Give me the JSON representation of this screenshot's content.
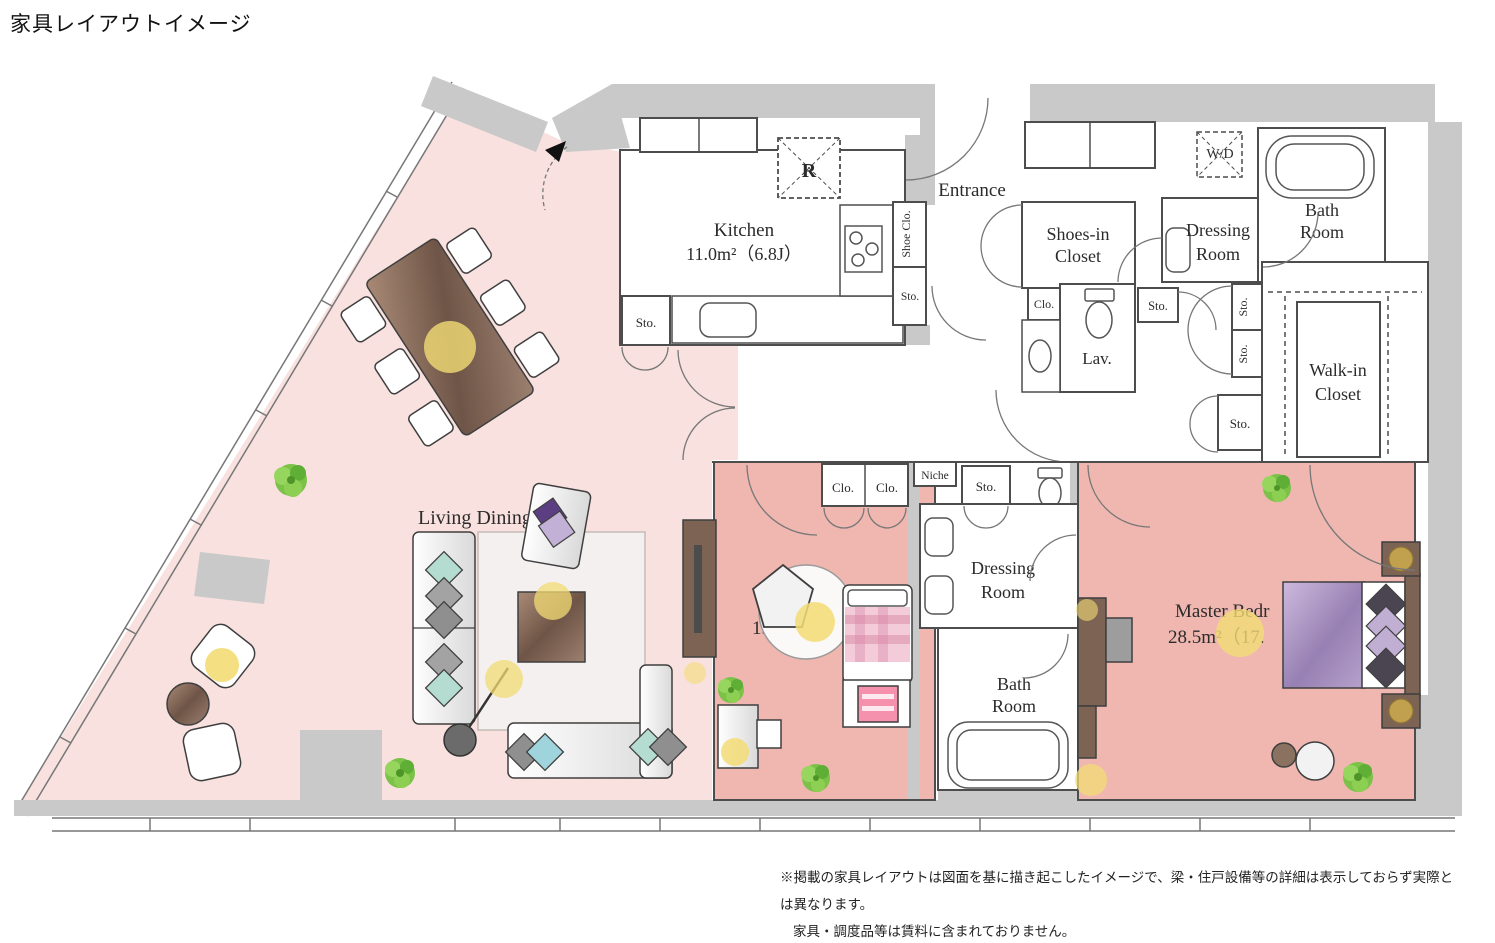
{
  "title": "家具レイアウトイメージ",
  "rooms": {
    "kitchen": {
      "name": "Kitchen",
      "area": "11.0m²（6.8J）"
    },
    "living_dining": {
      "name": "Living Dining Room"
    },
    "entrance": {
      "name": "Entrance"
    },
    "shoes_in_closet": {
      "line1": "Shoes-in",
      "line2": "Closet"
    },
    "dressing_room_top": {
      "line1": "Dressing",
      "line2": "Room"
    },
    "bath_room_top": {
      "line1": "Bath",
      "line2": "Room"
    },
    "lav": {
      "name": "Lav."
    },
    "walk_in_closet": {
      "line1": "Walk-in",
      "line2": "Closet"
    },
    "bedroom_middle": {
      "area_visible": "15."
    },
    "dressing_room_middle": {
      "line1": "Dressing",
      "line2": "Room"
    },
    "bath_room_middle": {
      "line1": "Bath",
      "line2": "Room"
    },
    "master_bedroom": {
      "name_visible": "Master Bedr",
      "area_visible": "28.5m²（17."
    }
  },
  "labels": {
    "r": "R",
    "wd": "W/D",
    "sto": "Sto.",
    "clo": "Clo.",
    "niche": "Niche",
    "shoe_clo": "Shoe Clo."
  },
  "notes": {
    "line1": "※掲載の家具レイアウトは図面を基に描き起こしたイメージで、梁・住戸設備等の詳細は表示しておらず実際とは異なります。",
    "line2": "家具・調度品等は賃料に含まれておりません。"
  },
  "colors": {
    "wall_gray": "#c9c9c9",
    "living_pink": "#f8e1de",
    "bedroom_pink": "#efb7b0",
    "bed_purple": "#a78fc0",
    "accent_yellow": "#f3dc74",
    "plant_green": "#7cc249",
    "chair_pink": "#f590ad",
    "wood_brown": "#8a6f5e"
  }
}
